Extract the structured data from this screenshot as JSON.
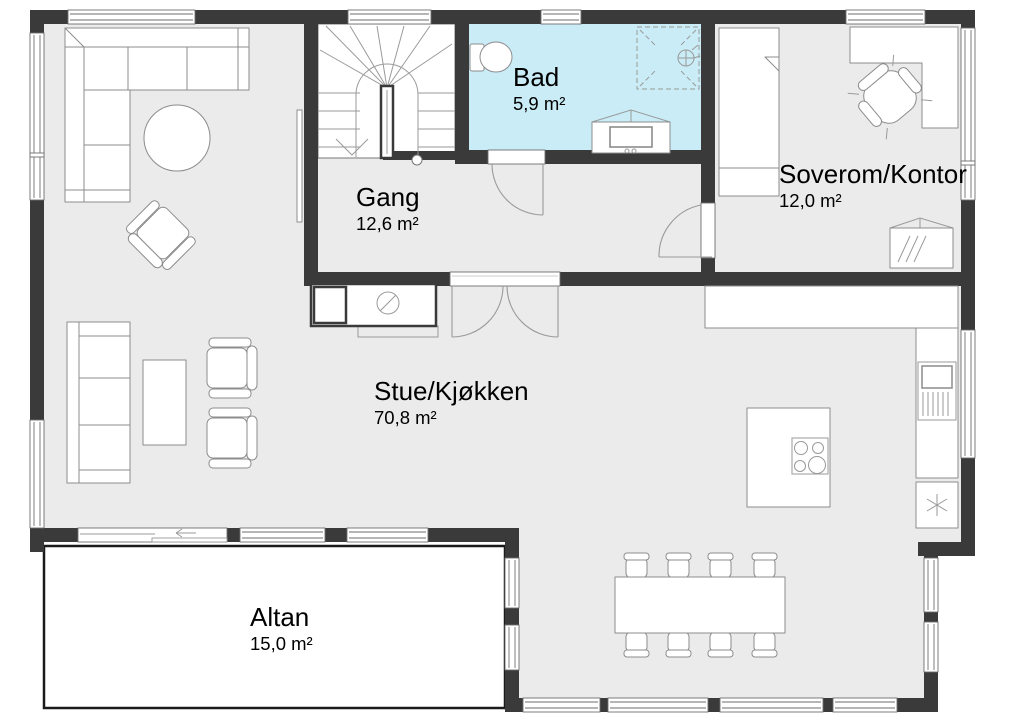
{
  "plan": {
    "type": "floor-plan",
    "language": "Norwegian",
    "rooms": [
      {
        "id": "bad",
        "name": "Bad",
        "area": "5,9 m²"
      },
      {
        "id": "gang",
        "name": "Gang",
        "area": "12,6 m²"
      },
      {
        "id": "soverom",
        "name": "Soverom/Kontor",
        "area": "12,0 m²"
      },
      {
        "id": "stue",
        "name": "Stue/Kjøkken",
        "area": "70,8 m²"
      },
      {
        "id": "altan",
        "name": "Altan",
        "area": "15,0 m²"
      }
    ],
    "fixtures": [
      "staircase",
      "toilet",
      "shower",
      "bathroom-vanity",
      "bed",
      "corner-desk",
      "office-chair",
      "dresser",
      "corner-sofa",
      "round-coffee-table",
      "armchair",
      "wall-tv",
      "sofa",
      "coffee-table",
      "wood-stove",
      "kitchen-counter",
      "kitchen-sink",
      "freezer",
      "kitchen-island",
      "cooktop",
      "dining-table",
      "dining-chairs",
      "sliding-door",
      "double-door"
    ],
    "theme": {
      "wall_color": "#3a3a3a",
      "floor_color": "#ebebeb",
      "bathroom_color": "#c9ecf7",
      "outline_color": "#8c8c8c",
      "background": "#ffffff"
    }
  }
}
